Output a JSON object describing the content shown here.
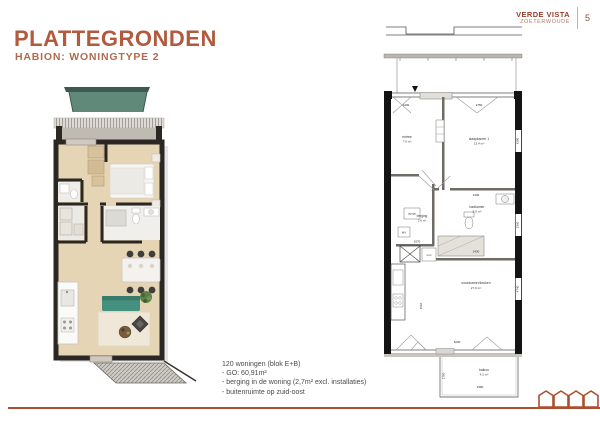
{
  "slide": {
    "title": "PLATTEGRONDEN",
    "subtitle": "HABION: WONINGTYPE 2"
  },
  "brand": {
    "name": "VERDE VISTA",
    "city": "ZOETERWOUDE",
    "page": "5"
  },
  "notes": {
    "heading": "120 woningen (blok E+B)",
    "items": [
      "- GO: 60,91m²",
      "- berging in de woning (2,7m² excl. installaties)",
      "- buitenruimte op zuid-oost"
    ]
  },
  "floorplan": {
    "rooms": {
      "entree": {
        "name": "entree",
        "area": "7.9 m²"
      },
      "slaapkamer1": {
        "name": "slaapkamer 1",
        "area": "13.4 m²"
      },
      "badkamer": {
        "name": "badkamer",
        "area": "5.0 m²"
      },
      "berging": {
        "name": "berging",
        "area": "2.6 m²"
      },
      "woonkamer": {
        "name": "woonkamer/keuken",
        "area": "27.9 m²"
      },
      "balkon": {
        "name": "balkon",
        "area": "4.2 m²"
      }
    },
    "equipment": {
      "wtw": "WTW",
      "mv": "MV",
      "wm": "wm"
    },
    "dimensions": {
      "top_left": "1200",
      "top_right": "2750",
      "bedroom_right": "4200",
      "badkamer_width": "2190",
      "badkamer_bottom": "2430",
      "badkamer_right": "2360",
      "berging_width": "1070",
      "living_left": "4510",
      "living_bottom": "5230",
      "living_right": "4740",
      "balkon_width": "2380",
      "balkon_depth": "1750"
    }
  },
  "colors": {
    "accent": "#ad4f2e",
    "brand_text": "#9a3c28",
    "wall": "#2b2824",
    "floor": "#e6d5b5",
    "sofa": "#459180",
    "canopy": "#61897a"
  }
}
